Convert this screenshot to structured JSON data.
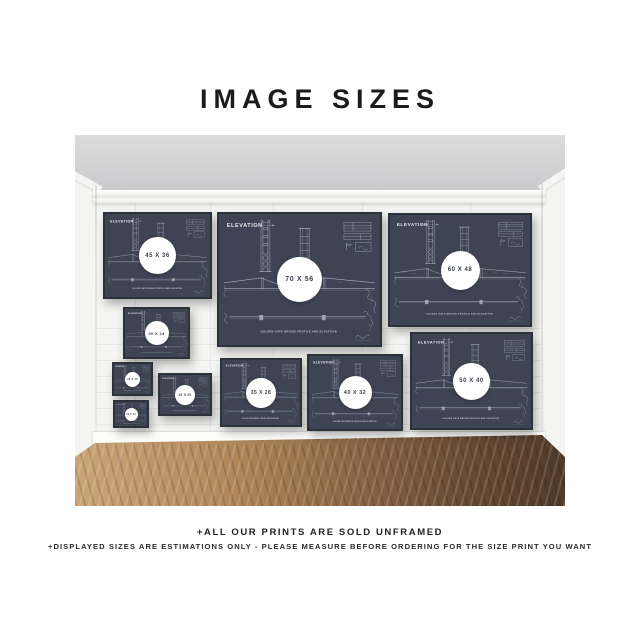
{
  "page": {
    "title": "IMAGE SIZES"
  },
  "footer": {
    "line1": "+ALL OUR PRINTS ARE SOLD UNFRAMED",
    "line2": "+DISPLAYED SIZES ARE ESTIMATIONS ONLY - PLEASE MEASURE BEFORE ORDERING FOR THE SIZE PRINT YOU WANT"
  },
  "print": {
    "title": "ELEVATION",
    "caption": "GOLDEN GATE BRIDGE PROFILE AND ELEVATION",
    "subject": "golden-gate-bridge-blueprint"
  },
  "frames": [
    {
      "label": "45 X 36"
    },
    {
      "label": "70 X 56"
    },
    {
      "label": "60 X 48"
    },
    {
      "label": "30 X 24"
    },
    {
      "label": "20 X 16"
    },
    {
      "label": "16 X 12"
    },
    {
      "label": "25 X 20"
    },
    {
      "label": "35 X 28"
    },
    {
      "label": "40 X 32"
    },
    {
      "label": "50 X 40"
    }
  ],
  "colors": {
    "print_background": "#3e4453",
    "blueprint_line": "#b7bdca",
    "wall": "#f4f4f2",
    "ceiling": "#cfcfd1",
    "floor_light": "#cba478",
    "floor_dark": "#503a2a",
    "badge_background": "#ffffff",
    "badge_text": "#3a3f4a",
    "title_text": "#1b1b1b"
  }
}
